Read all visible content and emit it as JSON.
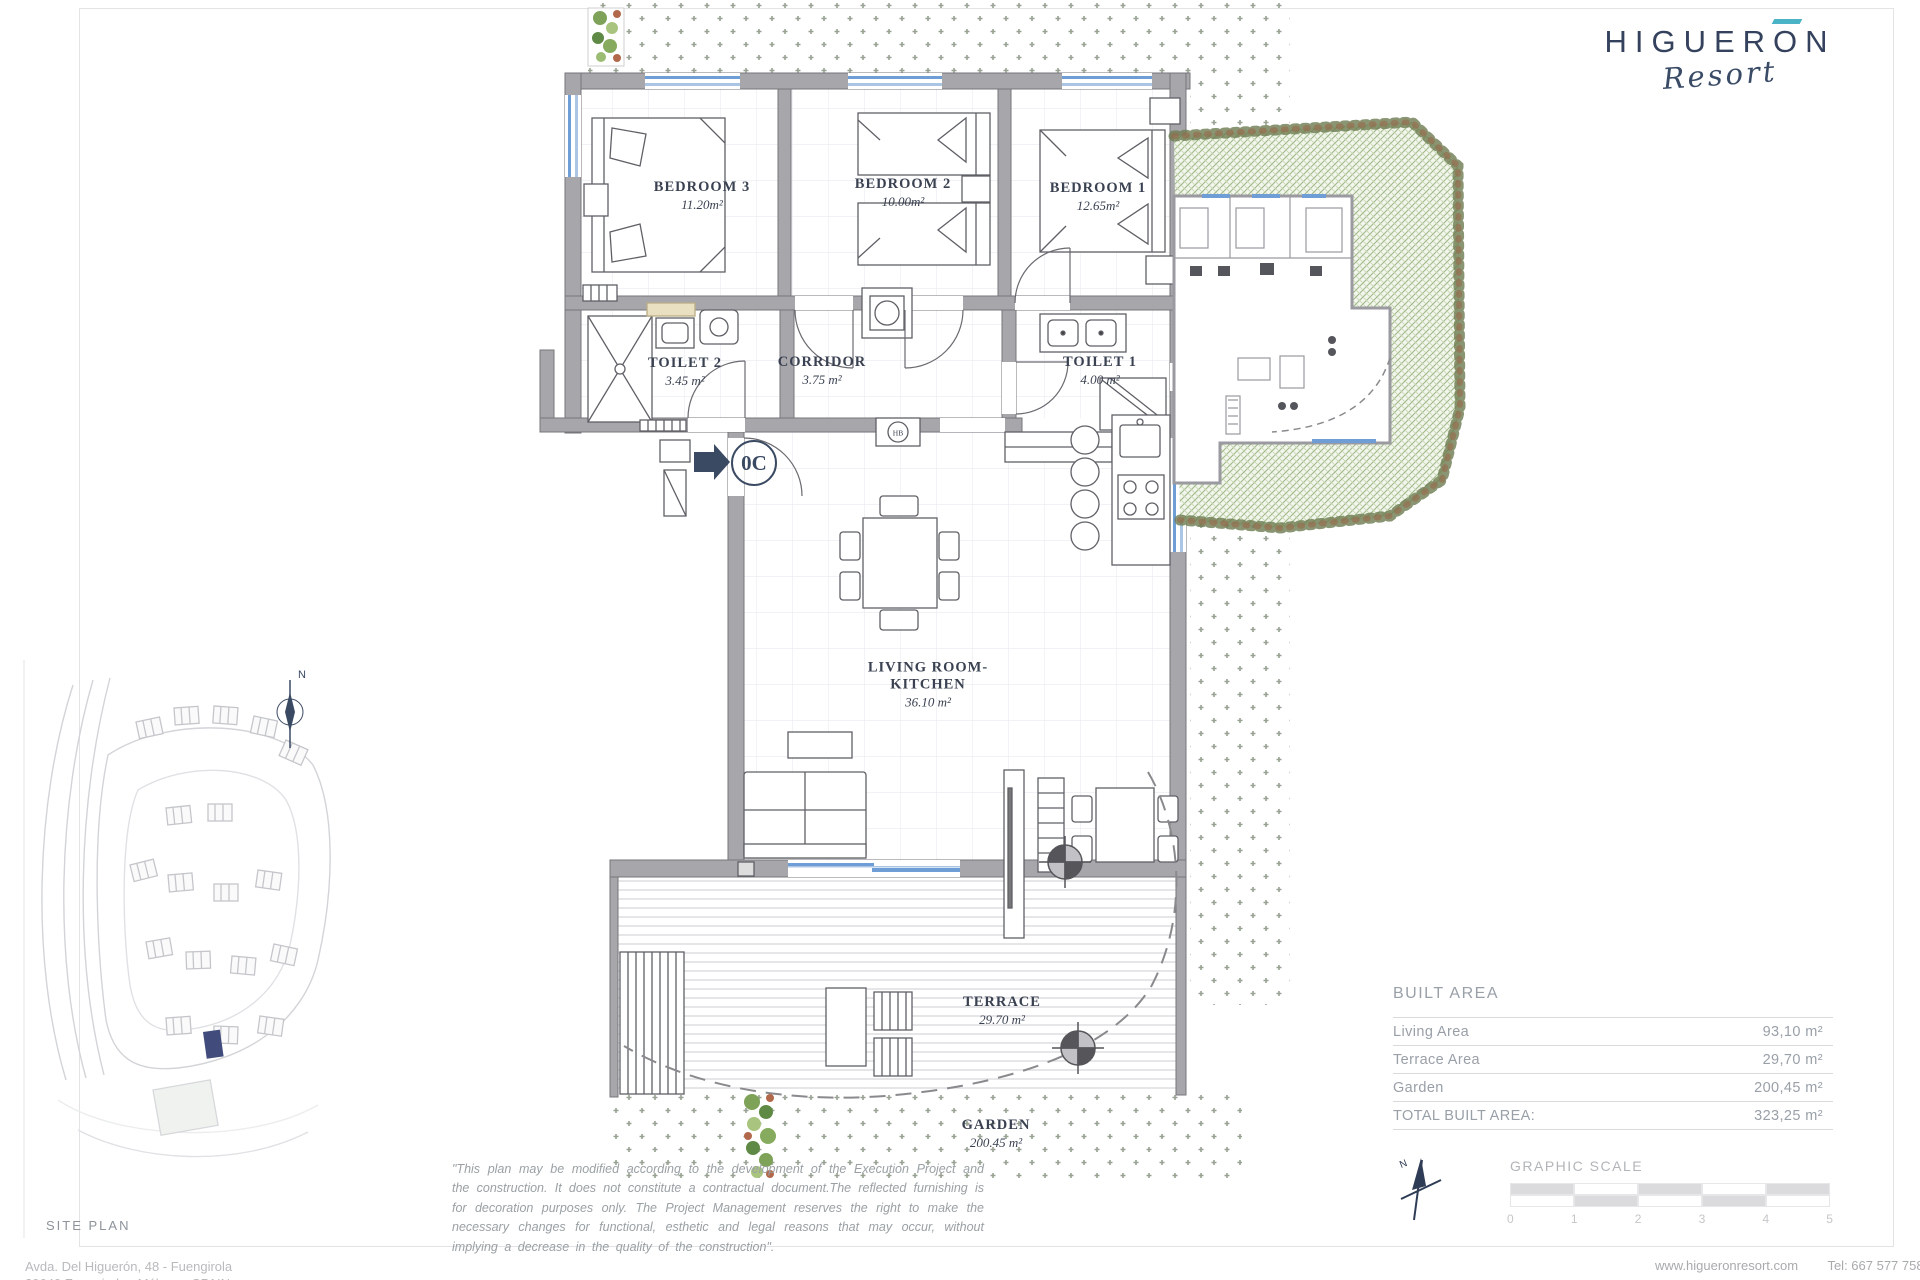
{
  "logo": {
    "brand_pre": "HIGUER",
    "brand_o": "O",
    "brand_post": "N",
    "sub": "Resort"
  },
  "plan": {
    "unit_badge": "0C",
    "hb_mark": "HB",
    "rooms": [
      {
        "name": "BEDROOM 3",
        "area": "11.20m²"
      },
      {
        "name": "BEDROOM 2",
        "area": "10.00m²"
      },
      {
        "name": "BEDROOM 1",
        "area": "12.65m²"
      },
      {
        "name": "TOILET 2",
        "area": "3.45 m²"
      },
      {
        "name": "CORRIDOR",
        "area": "3.75 m²"
      },
      {
        "name": "TOILET 1",
        "area": "4.00 m²"
      },
      {
        "name": "LIVING ROOM-KITCHEN",
        "area": "36.10 m²"
      },
      {
        "name": "TERRACE",
        "area": "29.70 m²"
      },
      {
        "name": "GARDEN",
        "area": "200.45 m²"
      }
    ]
  },
  "compass_n": "N",
  "site_plan_label": "SITE PLAN",
  "built_area": {
    "heading": "BUILT AREA",
    "rows": [
      {
        "label": "Living Area",
        "value": "93,10 m²"
      },
      {
        "label": "Terrace Area",
        "value": "29,70 m²"
      },
      {
        "label": "Garden",
        "value": "200,45 m²"
      },
      {
        "label": "TOTAL BUILT AREA:",
        "value": "323,25 m²"
      }
    ]
  },
  "graphic_scale": {
    "label": "GRAPHIC SCALE",
    "ticks": [
      "0",
      "1",
      "2",
      "3",
      "4",
      "5"
    ]
  },
  "disclaimer": "\"This plan may be modified according to the development of the Execution Project and the construction. It does not constitute a contractual document.The reflected furnishing is for decoration purposes only. The Project Management reserves the right to make the necessary changes for functional, esthetic and legal reasons that may occur, without implying a decrease in the quality of the construction\".",
  "footer": {
    "address_line1": "Avda. Del Higuerón, 48 - Fuengirola",
    "address_line2": "29640 Fuengirola - Málaga - SPAIN",
    "website": "www.higueronresort.com",
    "phone": "Tel: 667 577 758"
  },
  "colors": {
    "accent_teal": "#4ab3c6",
    "brand_navy": "#35425d",
    "window_blue": "#6f9ed6",
    "wall_gray": "#a6a6ab"
  }
}
